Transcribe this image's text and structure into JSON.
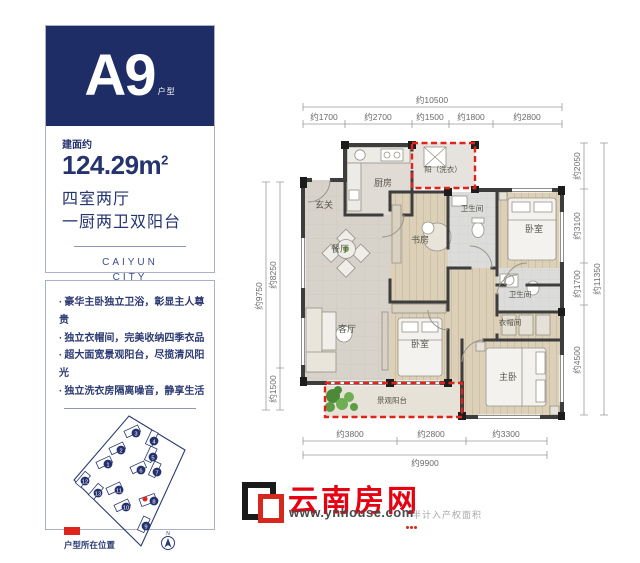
{
  "unit_card": {
    "code": "A9",
    "code_tag": "户型",
    "area_label": "建面约",
    "area_value": "124.29m",
    "area_sup": "2",
    "type_line1": "四室两厅",
    "type_line2": "一厨两卫双阳台",
    "brand_line1": "CAIYUN",
    "brand_line2": "CITY",
    "features": [
      "豪华主卧独立卫浴，彰显主人尊贵",
      "独立衣帽间，完美收纳四季衣品",
      "超大面宽景观阳台，尽揽清风阳光",
      "独立洗衣房隔离噪音，静享生活"
    ],
    "legend_label": "户型所在位置"
  },
  "site_plan": {
    "buildings": [
      "1",
      "2",
      "3",
      "4",
      "5",
      "6",
      "7",
      "8",
      "9",
      "10",
      "11",
      "12",
      "13"
    ],
    "compass": "N"
  },
  "floorplan": {
    "rooms": {
      "entry": "玄关",
      "kitchen": "厨房",
      "laundry": "阳（洗衣）",
      "dining": "餐厅",
      "study": "书房",
      "bath1": "卫生间",
      "bed1": "卧室",
      "living": "客厅",
      "bed2": "卧室",
      "bath2": "卫生间",
      "cloak": "衣帽间",
      "master": "主卧",
      "balcony": "景观阳台"
    },
    "dims": {
      "top_total": "约10500",
      "top": [
        "约1700",
        "约2700",
        "约1500",
        "约1800",
        "约2800"
      ],
      "bottom": [
        "约3800",
        "约2800",
        "约3300"
      ],
      "bottom_total": "约9900",
      "left": [
        "约8250",
        "约1500"
      ],
      "left_total": "约9750",
      "right": [
        "约2050",
        "约3100",
        "约1700",
        "约4500"
      ],
      "right_total": "约11350"
    }
  },
  "watermark": {
    "site_name": "云南房网",
    "url": "www.ynhouse.com",
    "note": "半计入产权面积"
  },
  "colors": {
    "navy": "#1f2d66",
    "plan_red": "#e0241c",
    "logo_red": "#e60012"
  }
}
